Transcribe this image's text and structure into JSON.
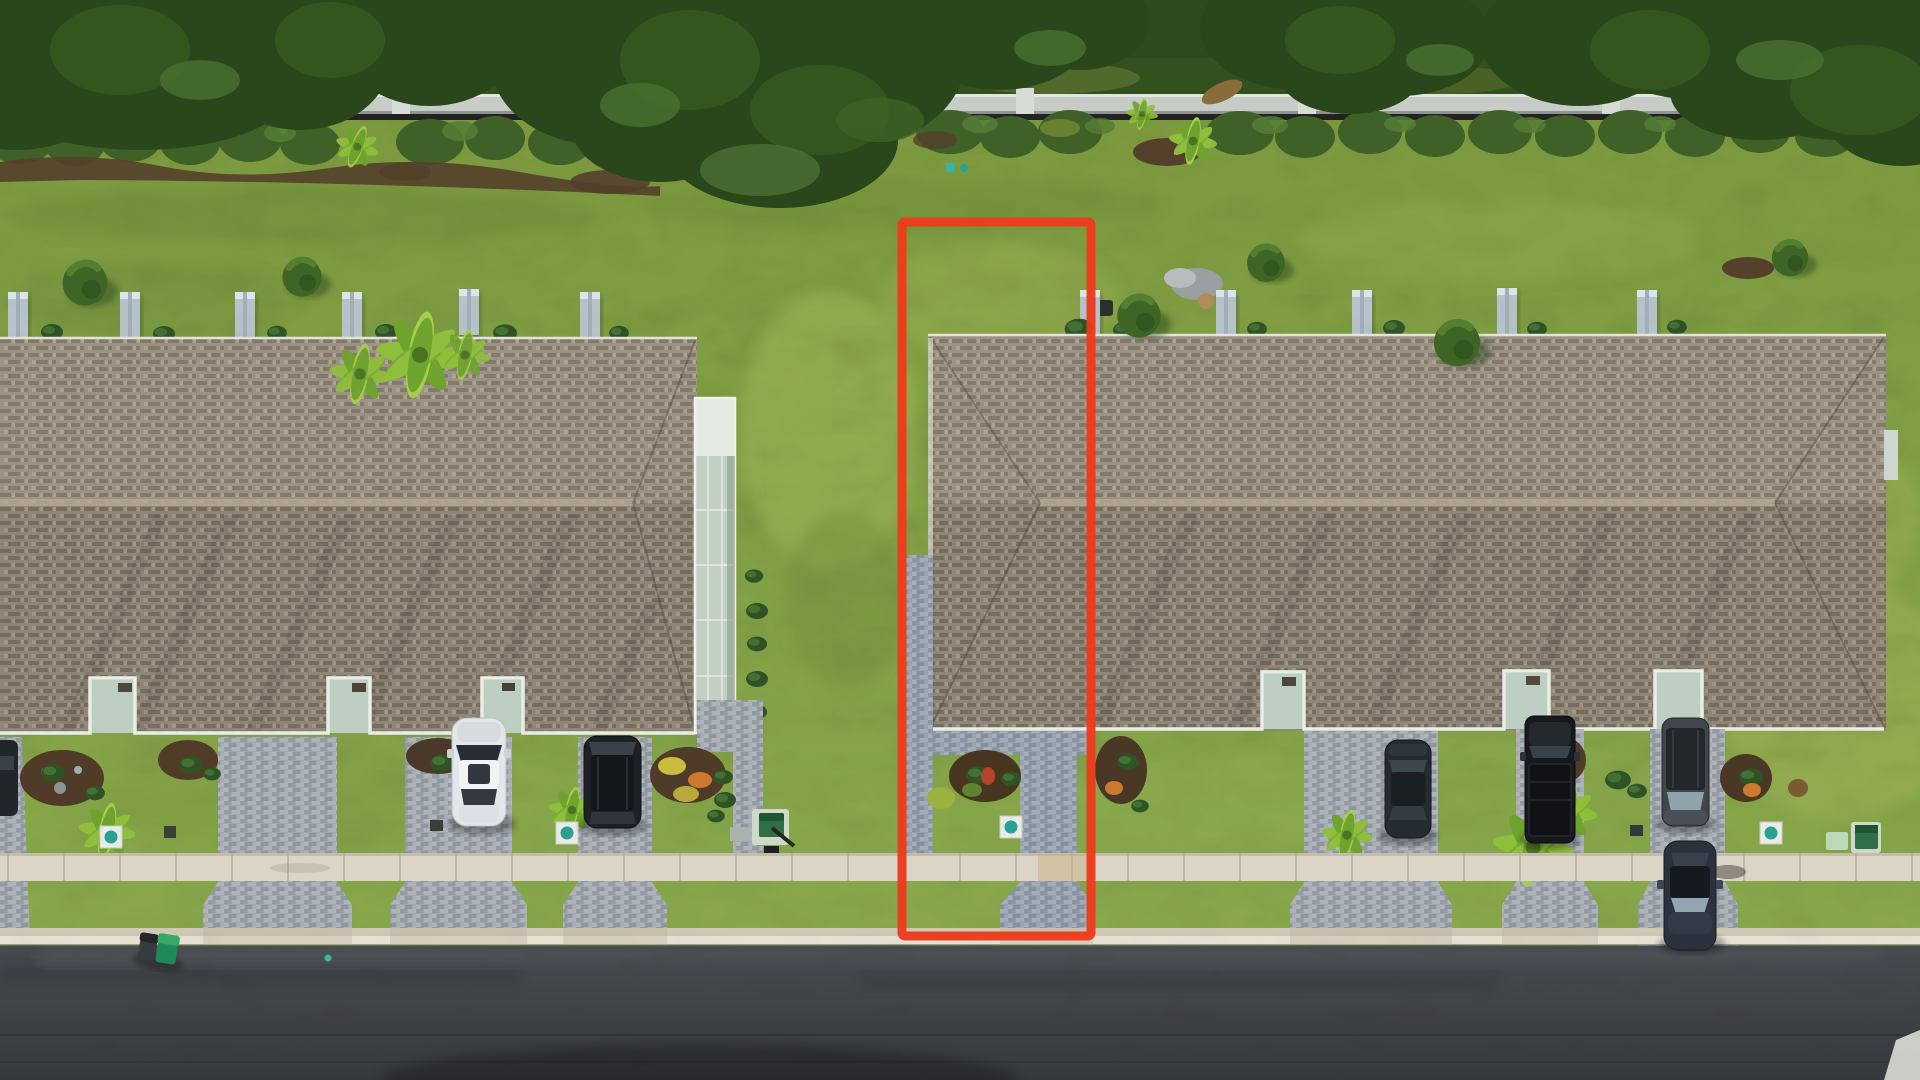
{
  "meta": {
    "type": "aerial-drone-photo",
    "description": "Top-down aerial photo of two rows of townhomes with shingle hip roofs, paver driveways, a concrete sidewalk, an asphalt street, and a red rectangle outlining one highlighted lot between the buildings.",
    "width": 1920,
    "height": 1080
  },
  "annotation": {
    "label": "highlighted-lot-boundary",
    "color": "#ee3a1c",
    "x": 902,
    "y": 222,
    "width": 189,
    "height": 714,
    "stroke_width": 9
  },
  "palette": {
    "tree_dark": "#2a471c",
    "tree_mid": "#35581f",
    "tree_light": "#4a7030",
    "hedge": "#3f6128",
    "hedge_light": "#557d36",
    "wall": "#c8ccc6",
    "wall_post": "#d8dcd6",
    "mulch": "#54402b",
    "lawn_top": "#7c9a3f",
    "lawn_bottom": "#88a84b",
    "lawn_shade": "#6d8c36",
    "lawn_light": "#9cb457",
    "roof_base": "#998f80",
    "roof_dash_dark": "#7e7365",
    "roof_dash_light": "#ab9f8e",
    "roof_ridge": "#b2a793",
    "gutter": "#e9eee5",
    "porch_floor": "#bccfc2",
    "porch_wall": "#f0f4ee",
    "lanai": "#c2d0c4",
    "fence_panel": "#b7c3cb",
    "paver_base": "#a1a8af",
    "paver_blue": "#96a0ac",
    "walkway": "#a3aab1",
    "sidewalk": "#dcd5c5",
    "sidewalk_joint": "#b6ae9d",
    "curb_light": "#cfc8b7",
    "curb_lower": "#e7e2d5",
    "road_top": "#474a4f",
    "road_bottom": "#36393d",
    "road_seam": "#2c2f33",
    "white_car": "#e4e7e9",
    "black_car": "#1d2125",
    "dark_sedan": "#262b31",
    "gray_suv": "#41464d",
    "blue_sedan": "#2b323d",
    "truck": "#17191d",
    "palm": "#8fbe3c",
    "palm_dark": "#6ea32e",
    "teal": "#2aa093",
    "utility_green": "#2f6e46",
    "trash_green": "#1f8a55",
    "trash_lid": "#39a86c",
    "trash_gray": "#363b40"
  },
  "scene": {
    "buildings": [
      {
        "name": "left-townhouse-row",
        "roof": "brown shingle hip roof",
        "porches": 3,
        "privacy_panels": 6,
        "extras": "screened lanai on right end"
      },
      {
        "name": "right-townhouse-row",
        "roof": "brown shingle hip roof",
        "porches": 3,
        "privacy_panels": 5
      }
    ],
    "vehicles": [
      {
        "name": "edge-car",
        "color": "dark gray",
        "location": "far left driveway sliver"
      },
      {
        "name": "white-sedan",
        "color": "white",
        "location": "left row driveway"
      },
      {
        "name": "black-suv",
        "color": "black",
        "location": "left row driveway"
      },
      {
        "name": "dark-sedan",
        "color": "dark gray",
        "location": "right row driveway"
      },
      {
        "name": "black-pickup",
        "color": "black",
        "location": "right row driveway"
      },
      {
        "name": "gray-suv",
        "color": "gray",
        "location": "right row porch driveway"
      },
      {
        "name": "blue-sedan",
        "color": "dark blue",
        "location": "crossing sidewalk toward street"
      }
    ],
    "objects": [
      "perimeter privacy wall",
      "hedge row",
      "ornamental palms",
      "paver driveways",
      "concrete sidewalk",
      "curb",
      "asphalt street",
      "green and gray trash carts",
      "teal utility pads",
      "green utility boxes"
    ]
  }
}
